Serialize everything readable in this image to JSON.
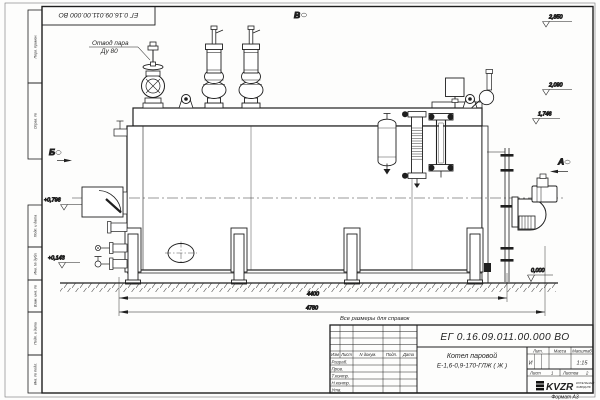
{
  "drawing": {
    "doc_number": "ЕГ 0.16.09.011.00.000  ВО",
    "title_line1": "Котел паровой",
    "title_line2": "Е-1,6-0,9-170-ГЛЖ ( Ж )",
    "note": "Все размеры для справок",
    "format": "Формат А3",
    "scale": "1:15",
    "liter": "И",
    "sheet_word": "Лист",
    "sheet_num": "1",
    "sheets_word": "Листов",
    "sheets_num": "2",
    "company": {
      "logo": "KVZR",
      "line1": "КОТЕЛЬНЫЙ",
      "line2": "ЗАВОД.РФ"
    }
  },
  "title_block": {
    "headers": {
      "izm": "Изм",
      "list": "Лист",
      "doc": "N докум.",
      "sign": "Подп.",
      "date": "Дата",
      "lit": "Лит.",
      "mass": "Масса",
      "scale": "Масштаб"
    },
    "roles": [
      "Разраб.",
      "Пров.",
      "Т.контр.",
      "Н.контр.",
      "Утв."
    ]
  },
  "side_stamps": [
    "Перв. примен.",
    "Справ. №",
    "Подп. и дата",
    "Инв. № дубл.",
    "Взам. инв. №",
    "Подп. и дата",
    "Инв. № подл."
  ],
  "callouts": {
    "line1": "Отвод пара",
    "line2": "Ду 80"
  },
  "views": {
    "v": "В",
    "b": "Б",
    "a": "А"
  },
  "dimensions": {
    "d1": "4400",
    "d2": "4780"
  },
  "elevations": {
    "e1": "2,850",
    "e2": "2,090",
    "e3": "1,746",
    "e4": "+0,796",
    "e5": "+0,143",
    "e6": "0,000"
  },
  "colors": {
    "line": "#1f1f1f",
    "paper": "#fdfdfc"
  }
}
